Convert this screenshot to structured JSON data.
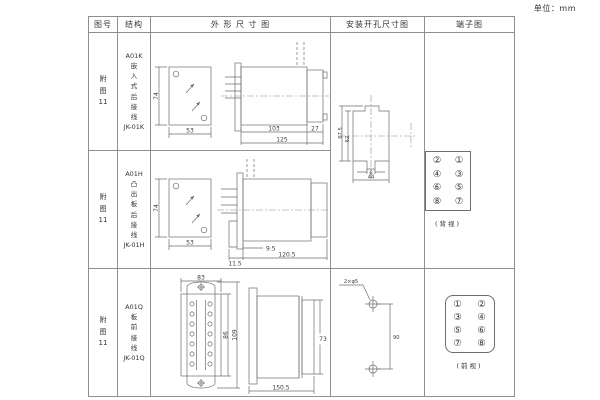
{
  "unit": "单位：mm",
  "columns": {
    "figure_no": "图号",
    "structure": "结构",
    "outline": "外 形 尺 寸 图",
    "install": "安装开孔尺寸图",
    "terminal": "端子图"
  },
  "rows": [
    {
      "figure_no": "附\n图\n11",
      "structure": "A01K\n嵌\n入\n式\n后\n接\n线\nJK-01K"
    },
    {
      "figure_no": "附\n图\n11",
      "structure": "A01H\n凸\n出\n板\n后\n接\n线\nJK-01H"
    },
    {
      "figure_no": "附\n图\n11",
      "structure": "A01Q\n板\n前\n接\n线\nJK-01Q"
    }
  ],
  "drawings": {
    "outline1": {
      "front_height": "74",
      "front_width": "53",
      "body_len": "103",
      "cap_len": "27",
      "total_len": "125"
    },
    "outline2": {
      "front_height": "74",
      "front_width": "53",
      "pin_len": "9.5",
      "flange_depth": "11.5",
      "total_len": "120.5"
    },
    "outline3": {
      "width": "83",
      "inner_height": "86",
      "outer_height": "109",
      "depth": "150.5",
      "side_height": "73"
    },
    "install12": {
      "outer_height": "67.5",
      "inner_height": "62",
      "notch_width": "6",
      "width": "44"
    },
    "install3": {
      "hole_label": "2×φ5",
      "spacing": "90"
    }
  },
  "terminals": {
    "rear": {
      "cells": [
        "②",
        "①",
        "④",
        "③",
        "⑥",
        "⑤",
        "⑧",
        "⑦"
      ],
      "caption": "(背视)"
    },
    "front": {
      "cells": [
        "①",
        "②",
        "③",
        "④",
        "⑤",
        "⑥",
        "⑦",
        "⑧"
      ],
      "caption": "(前视)"
    }
  }
}
